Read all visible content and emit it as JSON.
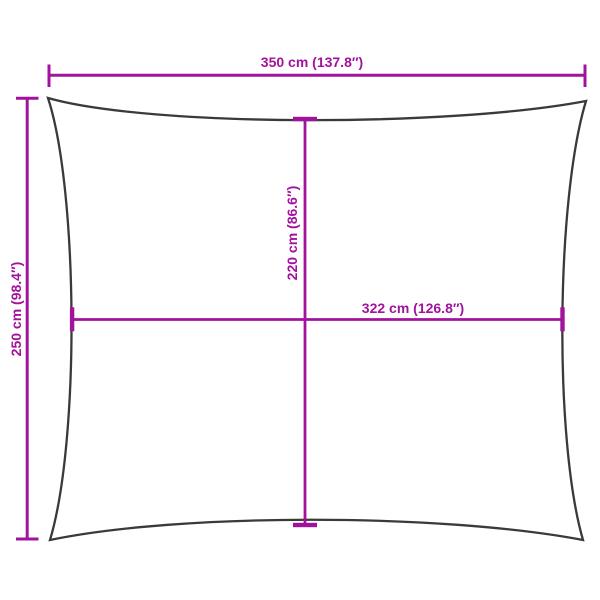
{
  "colors": {
    "background": "#ffffff",
    "outline": "#3a3a39",
    "dimension": "#a2139d"
  },
  "diagram": {
    "shape_name": "shade-sail-rectangle-outline",
    "dimensions": {
      "top_width": {
        "label": "350 cm (137.8″)"
      },
      "left_height": {
        "label": "250 cm (98.4″)"
      },
      "inner_height": {
        "label": "220 cm (86.6″)"
      },
      "inner_width": {
        "label": "322 cm (126.8″)"
      }
    }
  }
}
